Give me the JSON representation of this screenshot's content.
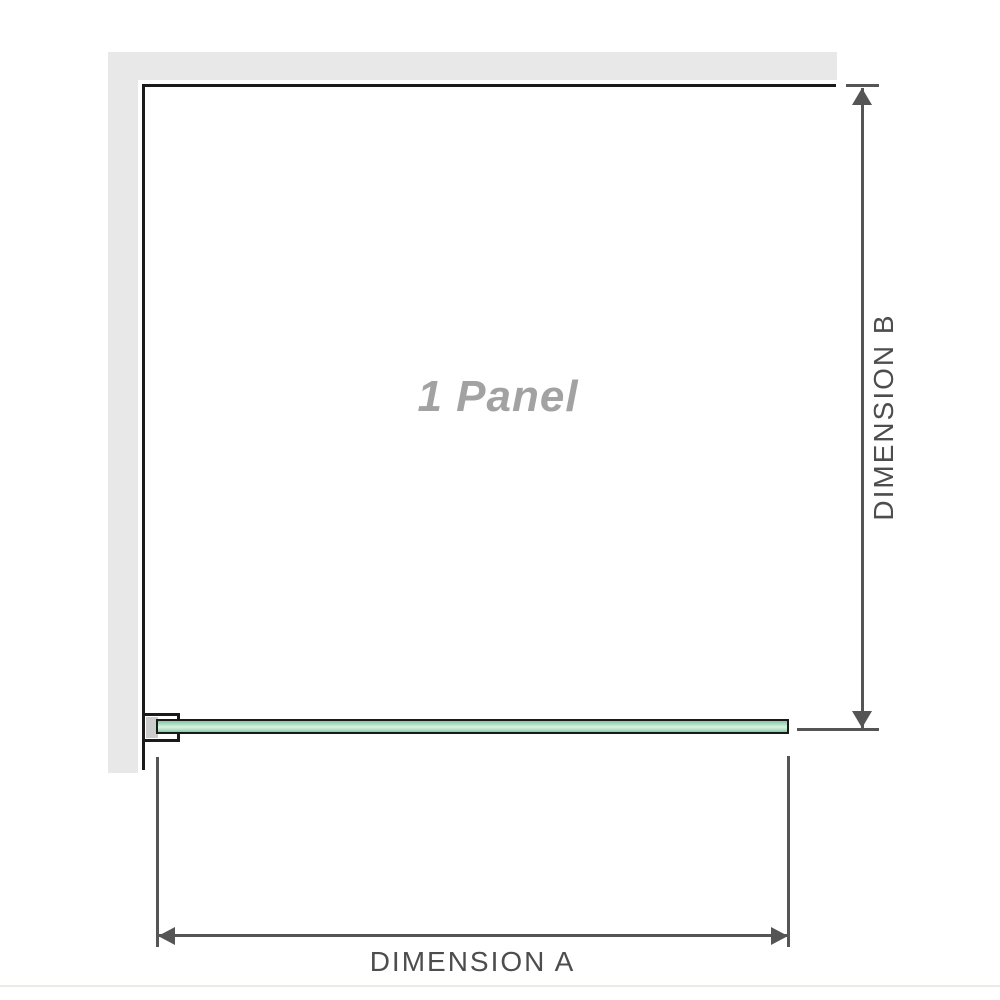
{
  "diagram": {
    "title_label": "1 Panel",
    "dimensions": {
      "vertical": {
        "label": "DIMENSION B"
      },
      "horizontal": {
        "label": "DIMENSION A"
      }
    },
    "icons": {
      "arrow_up": "filled-triangle-up",
      "arrow_down": "filled-triangle-down",
      "arrow_left": "filled-triangle-left",
      "arrow_right": "filled-triangle-right"
    },
    "colors": {
      "background": "#ffffff",
      "wall": "#e8e8e8",
      "outline": "#1a1a1a",
      "dimension_line": "#555555",
      "dimension_text": "#4d4d4d",
      "panel_text": "#a2a2a2",
      "glass_edge_dark": "#85c8a0",
      "glass_mid": "#aadfbf",
      "glass_light": "#ddf2e4",
      "bracket_pad": "#cccccc",
      "baseline": "#eceae5"
    }
  }
}
